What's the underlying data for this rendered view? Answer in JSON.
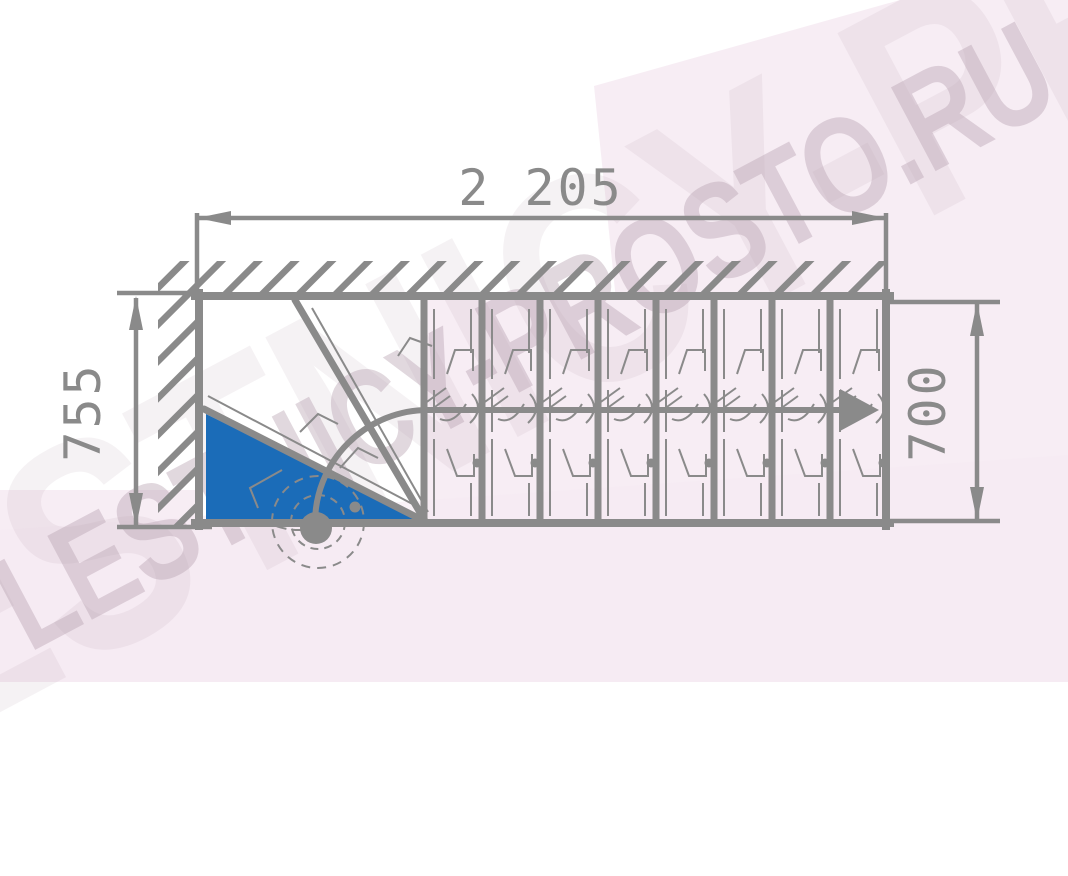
{
  "title": "staircase-plan-drawing",
  "dimensions": {
    "top": "2 205",
    "left": "755",
    "right": "700"
  },
  "watermark": {
    "text": "LESTNICY-PROSTO.RU"
  },
  "colors": {
    "line_gray": "#8a8a8a",
    "accent_blue": "#1b6cb8",
    "background_pink": "#f7edf4"
  },
  "drawing": {
    "type": "staircase-plan-top-view",
    "straight_tread_lines": 8,
    "winder_diagonals": 2,
    "highlighted_first_step_color": "#1b6cb8",
    "walk_line_direction": "right"
  }
}
